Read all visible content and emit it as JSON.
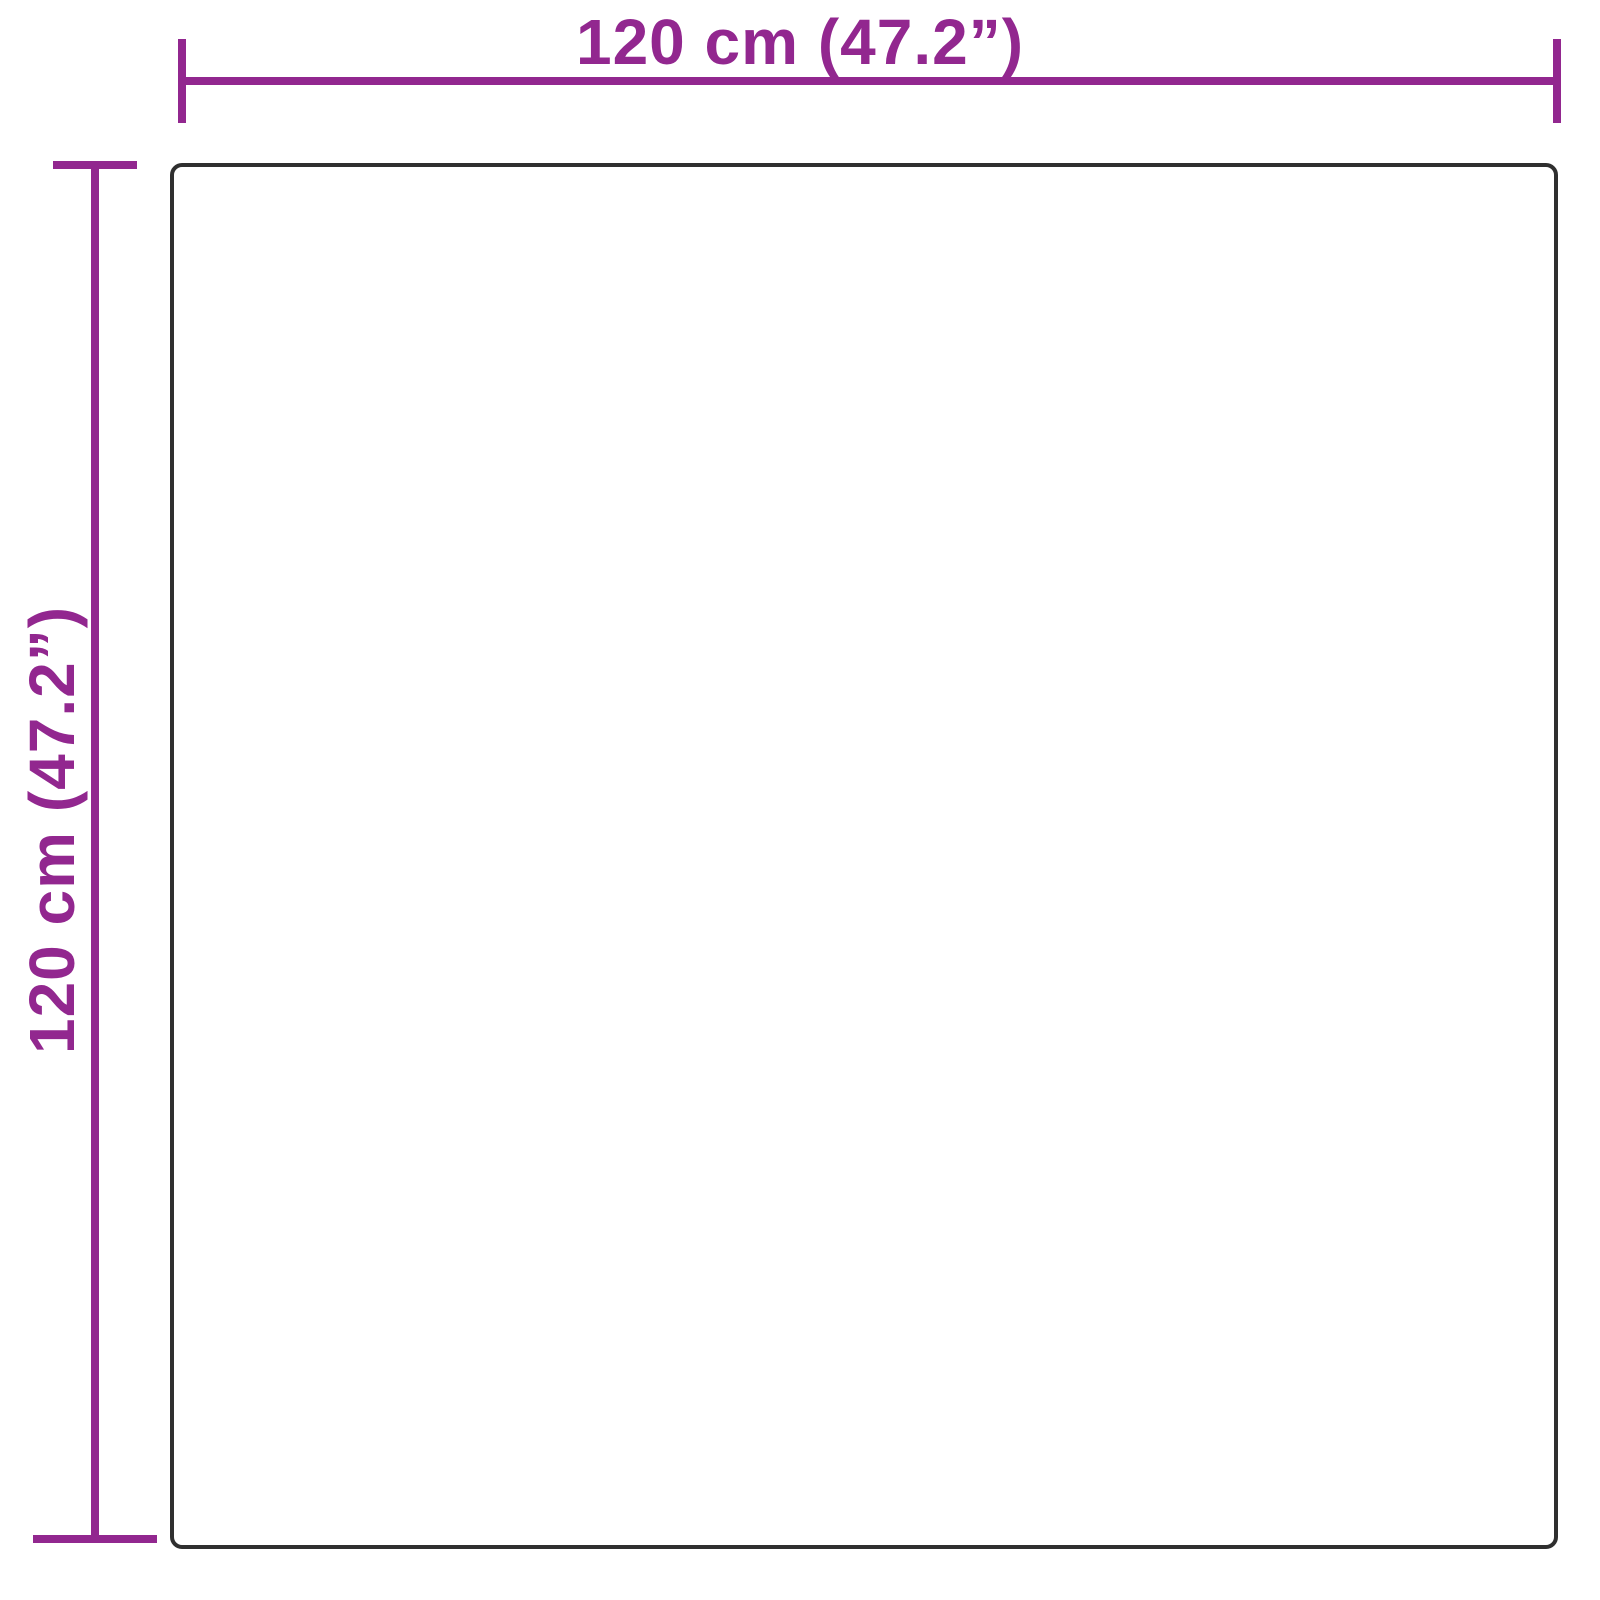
{
  "diagram": {
    "type": "product-dimension-diagram",
    "shape": "square",
    "width_dimension": {
      "label": "120 cm (47.2”)",
      "value_cm": 120,
      "value_inches": 47.2,
      "orientation": "horizontal",
      "position": "top"
    },
    "height_dimension": {
      "label": "120 cm (47.2”)",
      "value_cm": 120,
      "value_inches": 47.2,
      "orientation": "vertical",
      "position": "left"
    }
  },
  "colors": {
    "accent": "#92278f",
    "outline": "#2f2f2f",
    "background": "#ffffff"
  }
}
